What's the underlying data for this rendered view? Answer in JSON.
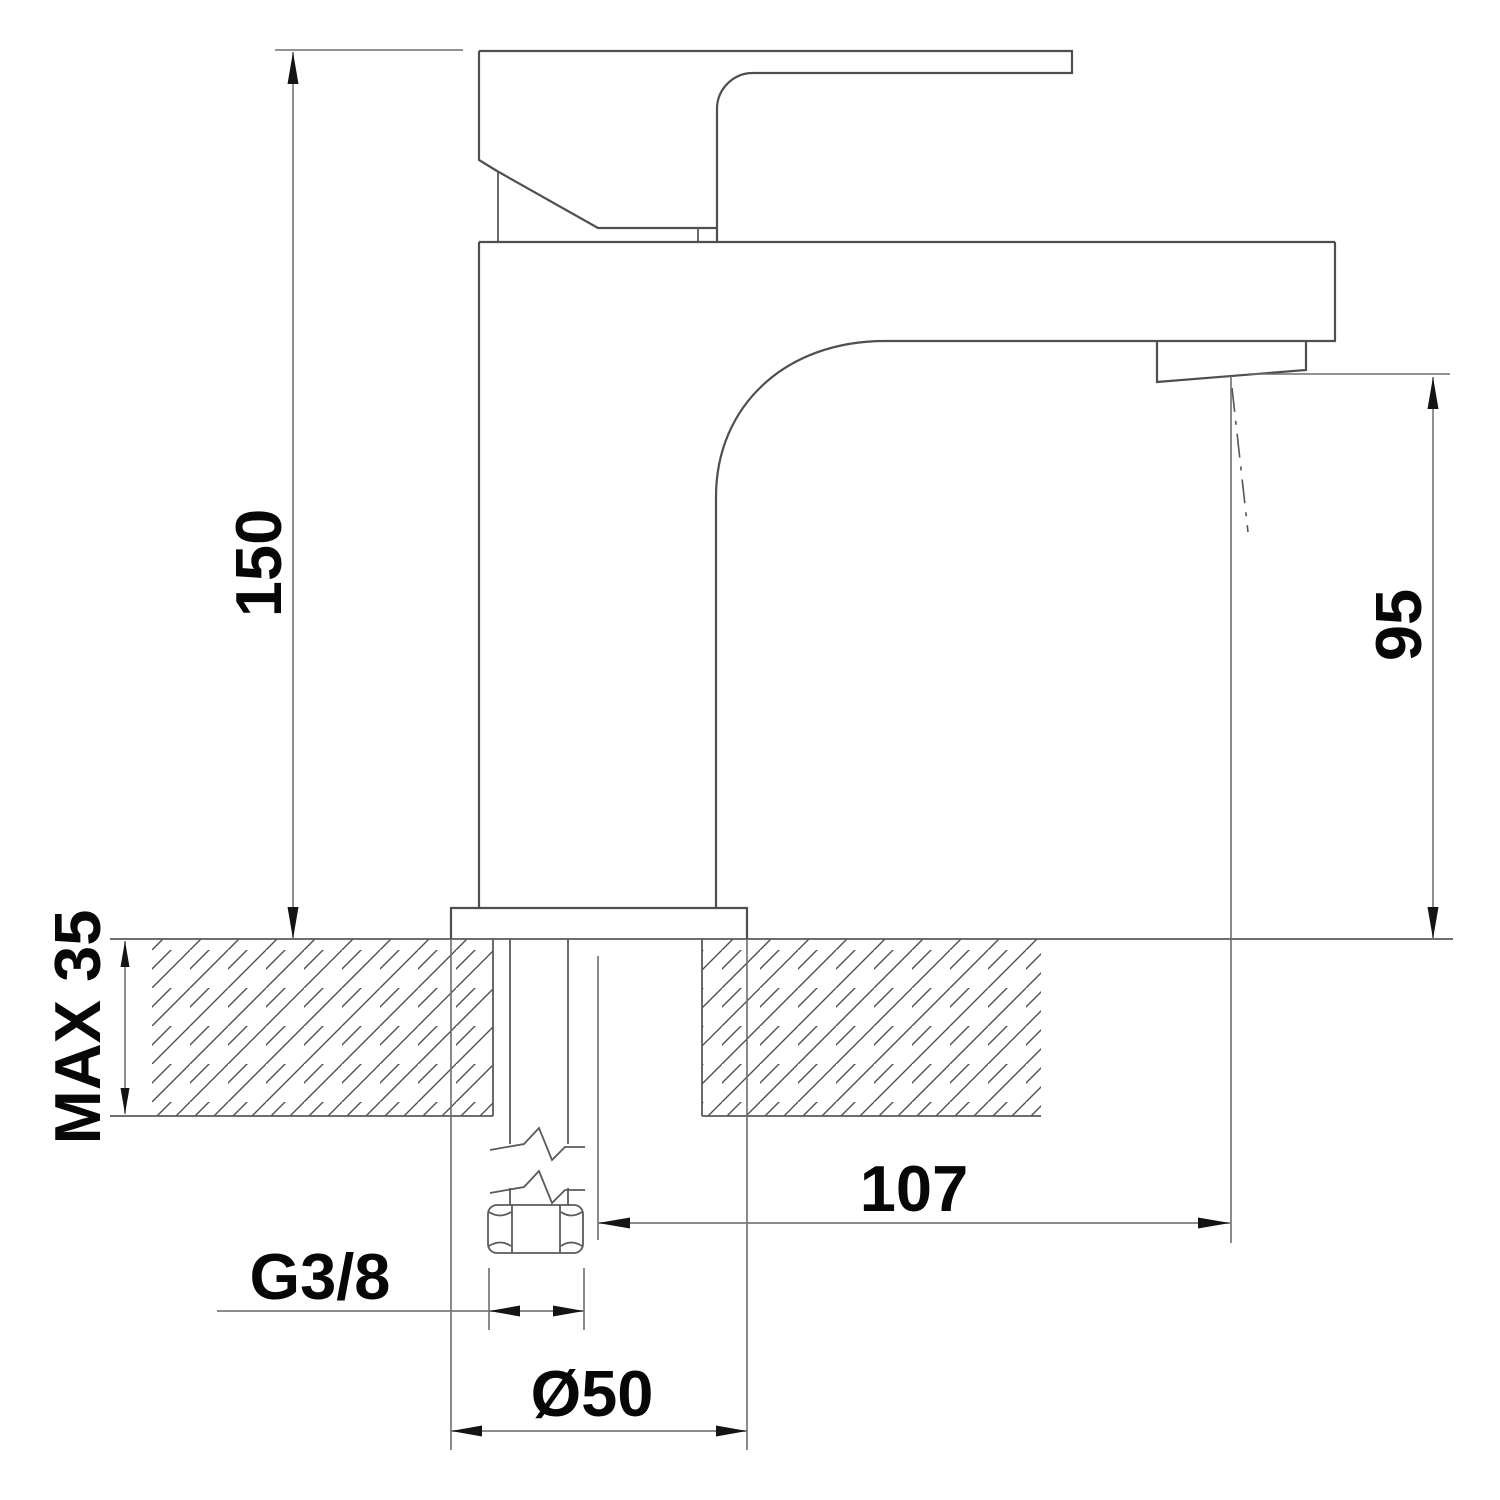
{
  "drawing": {
    "kind": "technical-dimension-drawing",
    "subject": "single-lever basin mixer tap, side elevation with mounting cross-section",
    "line_color": "#4f4f4f",
    "text_color": "#070707",
    "background": "#ffffff"
  },
  "dimensions": [
    {
      "id": "overall-height",
      "label": "150",
      "orientation": "vertical",
      "measures": "countertop to top of body/handle"
    },
    {
      "id": "outlet-height",
      "label": "95",
      "orientation": "vertical",
      "measures": "countertop to spout outlet"
    },
    {
      "id": "max-counter-thickness",
      "label": "MAX 35",
      "orientation": "vertical",
      "measures": "maximum mounting deck thickness"
    },
    {
      "id": "spout-reach",
      "label": "107",
      "orientation": "horizontal",
      "measures": "tap axis to outlet axis"
    },
    {
      "id": "supply-thread",
      "label": "G3/8",
      "orientation": "horizontal",
      "measures": "inlet connection thread"
    },
    {
      "id": "base-diameter",
      "label": "Ø50",
      "orientation": "horizontal",
      "measures": "base escutcheon diameter"
    }
  ]
}
